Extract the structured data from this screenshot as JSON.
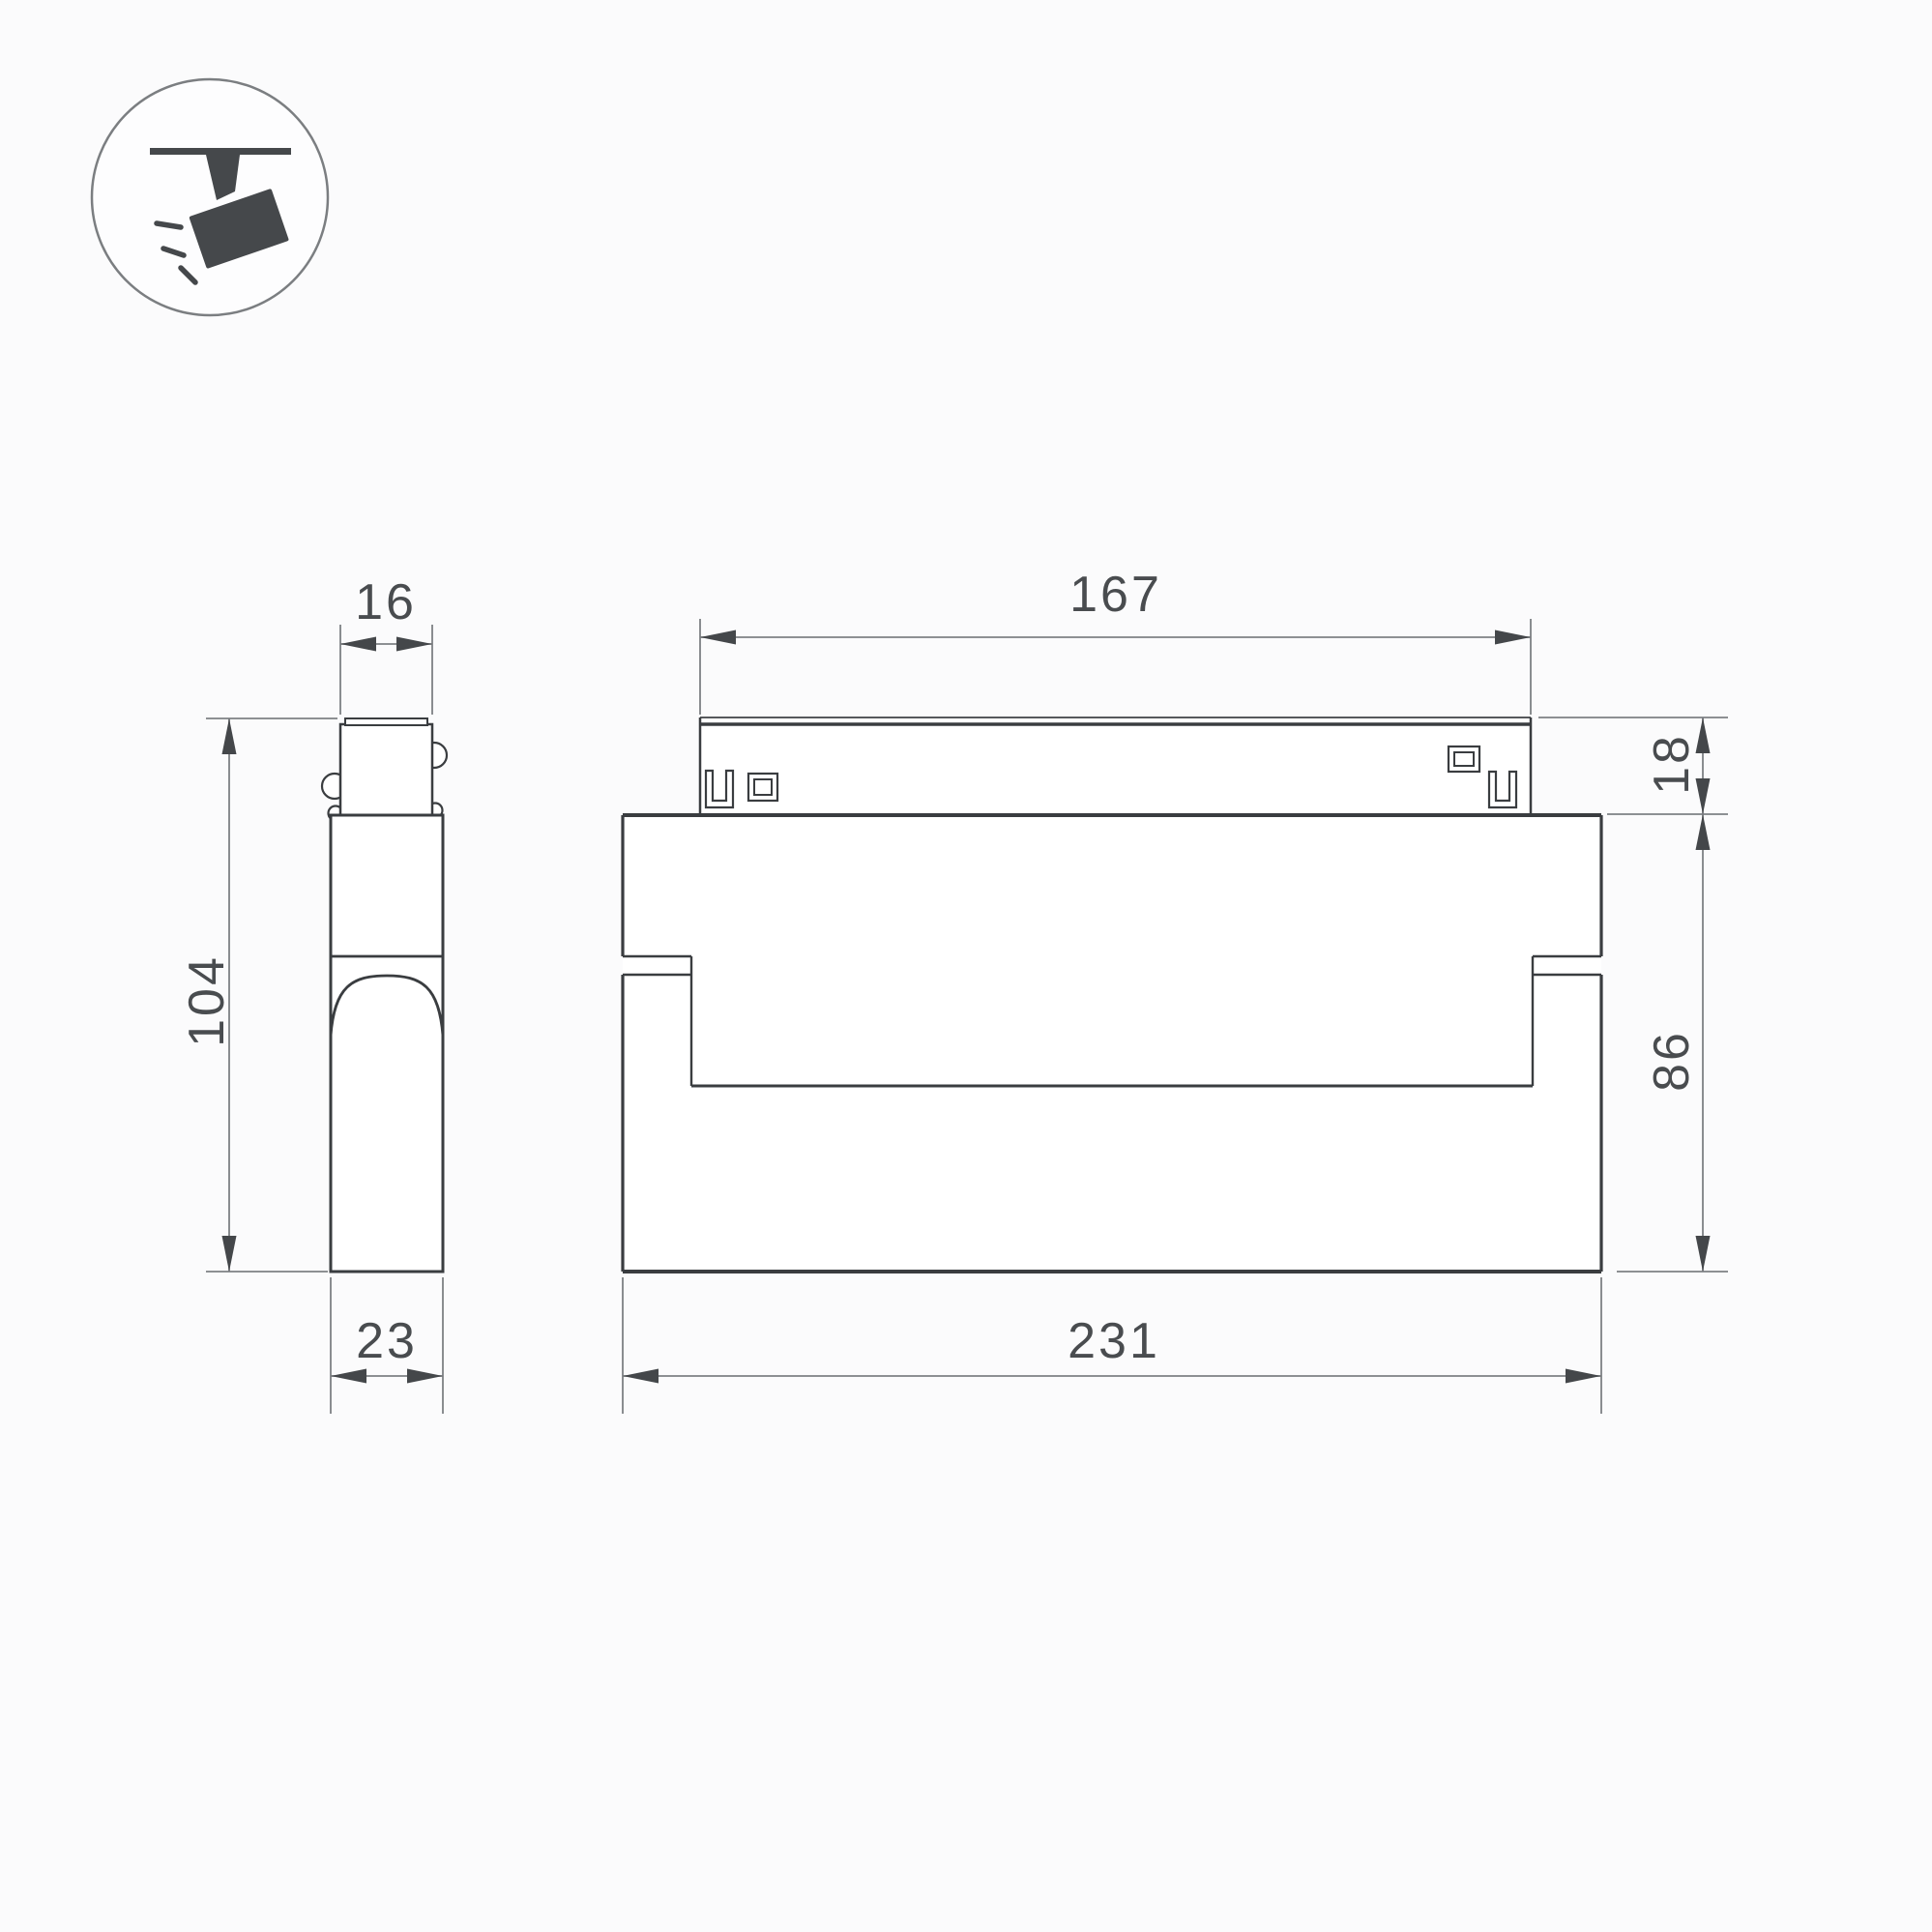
{
  "page": {
    "background_color": "#fbfbfc",
    "type": "technical-dimension-drawing",
    "product": "magnetic track spotlight"
  },
  "legend_icon": {
    "name": "track-spotlight-icon",
    "parts": [
      "ceiling-track-bar",
      "mount-stem",
      "tilted-spotlight-head",
      "light-rays"
    ]
  },
  "dimensions": {
    "side_view": {
      "adapter_width": "16",
      "overall_height": "104",
      "body_depth": "23"
    },
    "front_view": {
      "adapter_length": "167",
      "adapter_height": "18",
      "body_height": "86",
      "body_length": "231"
    }
  },
  "colors": {
    "outline": "#3a3d40",
    "dimension_lines": "#7e8184",
    "label_text": "#494c4f",
    "icon_fill": "#45484b",
    "background": "#fbfbfc"
  }
}
